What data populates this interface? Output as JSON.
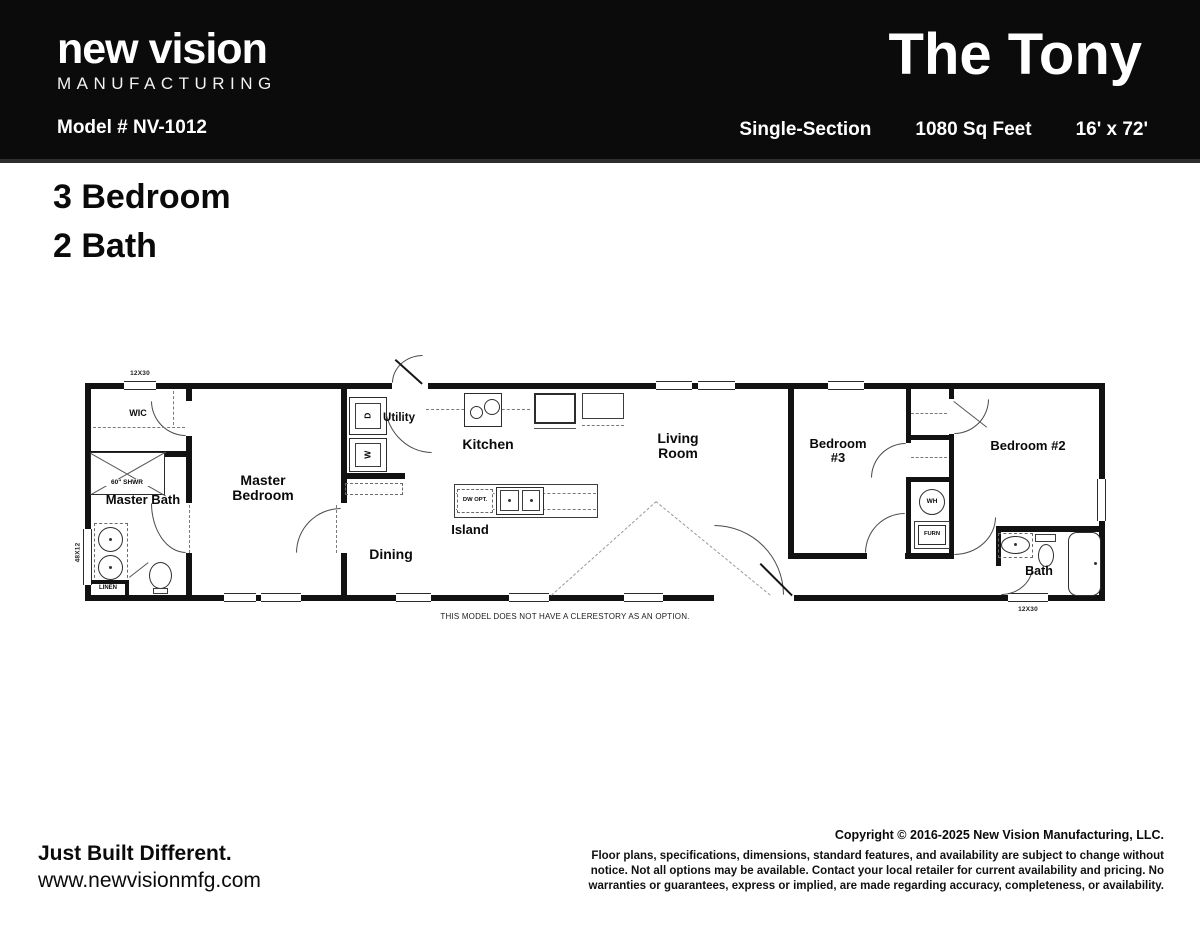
{
  "header": {
    "logo_line1": "new vision",
    "logo_line2": "MANUFACTURING",
    "model": "Model # NV-1012",
    "plan_name": "The Tony",
    "spec_section": "Single-Section",
    "spec_sqft": "1080 Sq Feet",
    "spec_size": "16' x 72'"
  },
  "summary": {
    "line1": "3 Bedroom",
    "line2": "2 Bath"
  },
  "floorplan": {
    "note": "THIS MODEL DOES NOT HAVE A CLERESTORY AS AN OPTION.",
    "rooms": {
      "wic": "WIC",
      "master_bath": "Master Bath",
      "master_bedroom": "Master Bedroom",
      "utility": "Utility",
      "kitchen": "Kitchen",
      "island": "Island",
      "dining": "Dining",
      "living_room": "Living Room",
      "bedroom3": "Bedroom #3",
      "bedroom2": "Bedroom #2",
      "bath": "Bath"
    },
    "fixtures": {
      "shower": "60\" SHWR",
      "linen": "LINEN",
      "dryer": "D",
      "washer": "W",
      "dishwasher_optional": "DW OPT.",
      "water_heater": "WH",
      "furnace": "FURN"
    },
    "window_dimensions": {
      "wic_window": "12X30",
      "master_bath_window": "48X12",
      "bath_window": "12X30"
    }
  },
  "footer": {
    "tagline": "Just Built Different.",
    "website": "www.newvisionmfg.com",
    "copyright": "Copyright © 2016-2025 New Vision Manufacturing, LLC.",
    "disclaimer": "Floor plans, specifications, dimensions, standard features, and availability are subject to change without notice. Not all options may be available. Contact your local retailer for current availability and pricing. No warranties or guarantees, express or implied, are made regarding accuracy, completeness, or availability."
  }
}
